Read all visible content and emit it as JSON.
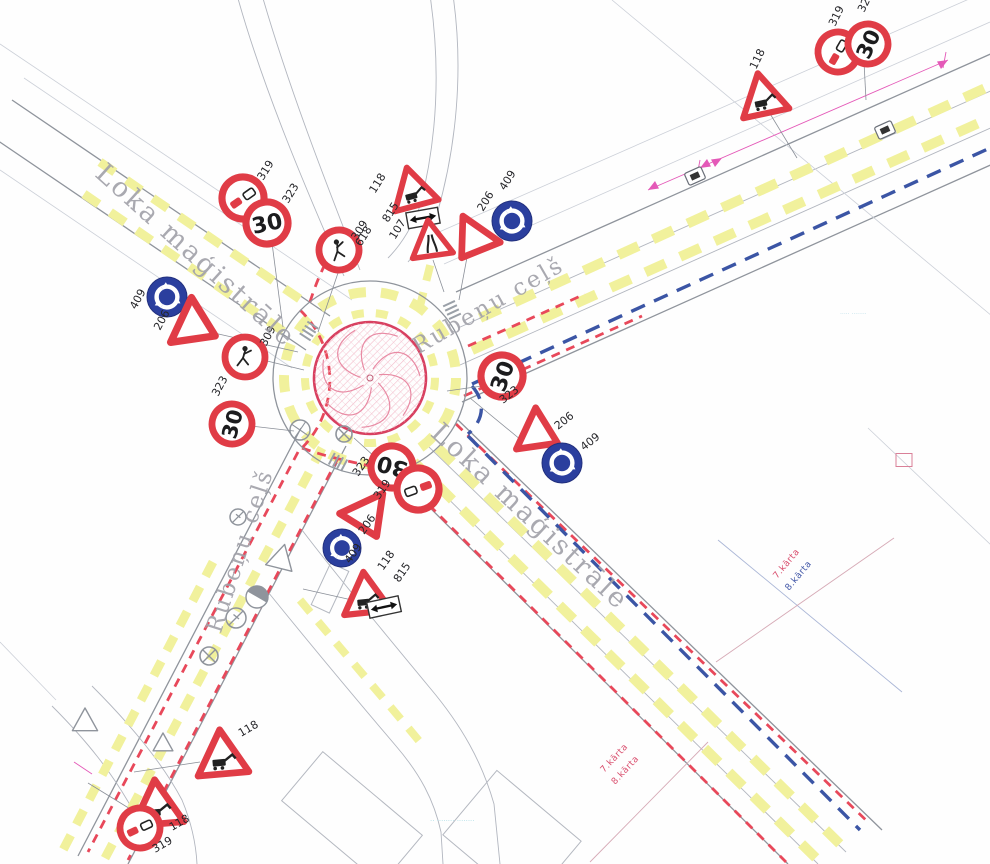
{
  "plan": {
    "type": "roundabout traffic-management scheme drawing",
    "colors": {
      "sign_red": "#e03c46",
      "sign_blue": "#2b3f9e",
      "marking_yellow": "#f1f19c",
      "temp_red": "#e8485a",
      "phase_blue": "#3b55a5",
      "magenta": "#e459b8",
      "island_pink": "#d84060",
      "road_gray": "#8f949c"
    },
    "sign_glyphs": {
      "speed_limit_text": "30"
    },
    "street_labels": [
      {
        "text": "Loka maģistrāle",
        "x": 190,
        "y": 262,
        "rot": 42,
        "size": 27
      },
      {
        "text": "Rubeņu ceļš",
        "x": 492,
        "y": 312,
        "rot": -30,
        "size": 23
      },
      {
        "text": "Rubeņu ceļš",
        "x": 247,
        "y": 553,
        "rot": -72,
        "size": 23
      },
      {
        "text": "Loka maģistrāle",
        "x": 524,
        "y": 523,
        "rot": 43,
        "size": 27
      }
    ],
    "phase_labels": [
      {
        "text": "7.kārta",
        "x": 777,
        "y": 579,
        "rot": -50,
        "color": "#d94f6e"
      },
      {
        "text": "8.kārta",
        "x": 789,
        "y": 591,
        "rot": -50,
        "color": "#4459a8"
      },
      {
        "text": "7.kārta",
        "x": 604,
        "y": 773,
        "rot": -47,
        "color": "#d94f6e"
      },
      {
        "text": "8.kārta",
        "x": 615,
        "y": 785,
        "rot": -47,
        "color": "#d94f6e"
      }
    ],
    "stray_labels": [
      {
        "text": "618",
        "x": 361,
        "y": 247,
        "rot": -58
      }
    ],
    "watermarks": [
      {
        "text": "·· ········ ········",
        "x": 430,
        "y": 823,
        "size": 7,
        "color": "#a9dce6"
      },
      {
        "text": "····· ········",
        "x": 840,
        "y": 316,
        "size": 6,
        "color": "#b9dde8"
      }
    ],
    "signs": [
      {
        "type": "no-overtake",
        "x": 243,
        "y": 198,
        "r": 21,
        "rot": -35,
        "label": "319",
        "lx": 263,
        "ly": 181,
        "lrot": -58
      },
      {
        "type": "speed30",
        "x": 267,
        "y": 223,
        "r": 21,
        "rot": -12,
        "label": "323",
        "lx": 288,
        "ly": 204,
        "lrot": -58
      },
      {
        "type": "pedestrian",
        "x": 339,
        "y": 250,
        "r": 20,
        "rot": -18,
        "label": "309",
        "lx": 357,
        "ly": 241,
        "lrot": -58
      },
      {
        "type": "roadworks",
        "x": 413,
        "y": 191,
        "s": 23,
        "rot": -15,
        "label": "118",
        "lx": 375,
        "ly": 194,
        "lrot": -58
      },
      {
        "type": "two-way-plate",
        "x": 423,
        "y": 218,
        "w": 32,
        "h": 16,
        "rot": -10,
        "label": "815",
        "lx": 388,
        "ly": 223,
        "lrot": -58
      },
      {
        "type": "road-narrows",
        "x": 431,
        "y": 242,
        "s": 21,
        "rot": -8,
        "label": "107",
        "lx": 395,
        "ly": 240,
        "lrot": -58
      },
      {
        "type": "give-way",
        "x": 474,
        "y": 240,
        "s": 24,
        "rot": 35,
        "label": "206",
        "lx": 483,
        "ly": 212,
        "lrot": -58
      },
      {
        "type": "roundabout",
        "x": 512,
        "y": 221,
        "r": 20,
        "rot": 0,
        "label": "409",
        "lx": 505,
        "ly": 191,
        "lrot": -58
      },
      {
        "type": "roundabout",
        "x": 167,
        "y": 297,
        "r": 20,
        "rot": 0,
        "label": "409",
        "lx": 136,
        "ly": 310,
        "lrot": -62
      },
      {
        "type": "give-way",
        "x": 194,
        "y": 326,
        "s": 26,
        "rot": -65,
        "label": "206",
        "lx": 160,
        "ly": 331,
        "lrot": -62
      },
      {
        "type": "pedestrian",
        "x": 245,
        "y": 357,
        "r": 20,
        "rot": 0,
        "label": "309",
        "lx": 266,
        "ly": 347,
        "lrot": -62
      },
      {
        "type": "speed30",
        "x": 232,
        "y": 424,
        "r": 20,
        "rot": -75,
        "label": "323",
        "lx": 218,
        "ly": 397,
        "lrot": -62
      },
      {
        "type": "speed30",
        "x": 502,
        "y": 376,
        "r": 21,
        "rot": -70,
        "label": "323",
        "lx": 503,
        "ly": 404,
        "lrot": -38
      },
      {
        "type": "give-way",
        "x": 538,
        "y": 434,
        "s": 24,
        "rot": -65,
        "label": "206",
        "lx": 558,
        "ly": 430,
        "lrot": -38
      },
      {
        "type": "roundabout",
        "x": 562,
        "y": 463,
        "r": 20,
        "rot": 0,
        "label": "409",
        "lx": 584,
        "ly": 451,
        "lrot": -38
      },
      {
        "type": "speed30",
        "x": 392,
        "y": 467,
        "r": 21,
        "rot": 195,
        "label": "323",
        "lx": 358,
        "ly": 477,
        "lrot": -55
      },
      {
        "type": "no-overtake",
        "x": 418,
        "y": 489,
        "r": 21,
        "rot": 160,
        "label": "319",
        "lx": 379,
        "ly": 500,
        "lrot": -55
      },
      {
        "type": "give-way",
        "x": 367,
        "y": 516,
        "s": 25,
        "rot": -25,
        "label": "206",
        "lx": 364,
        "ly": 535,
        "lrot": -55
      },
      {
        "type": "roundabout",
        "x": 342,
        "y": 548,
        "r": 19,
        "rot": 0,
        "label": "409",
        "lx": 350,
        "ly": 564,
        "lrot": -55
      },
      {
        "type": "roadworks",
        "x": 366,
        "y": 597,
        "s": 24,
        "rot": -6,
        "label": "118",
        "lx": 383,
        "ly": 571,
        "lrot": -55
      },
      {
        "type": "two-way-plate",
        "x": 384,
        "y": 607,
        "w": 32,
        "h": 16,
        "rot": -12,
        "label": "815",
        "lx": 399,
        "ly": 583,
        "lrot": -55
      },
      {
        "type": "roadworks",
        "x": 763,
        "y": 98,
        "s": 24,
        "rot": -12,
        "label": "118",
        "lx": 756,
        "ly": 70,
        "lrot": -64
      },
      {
        "type": "no-overtake",
        "x": 838,
        "y": 52,
        "r": 20,
        "rot": -60,
        "label": "319",
        "lx": 835,
        "ly": 27,
        "lrot": -64
      },
      {
        "type": "speed30",
        "x": 868,
        "y": 44,
        "r": 20,
        "rot": -65,
        "label": "323",
        "lx": 864,
        "ly": 13,
        "lrot": -64
      },
      {
        "type": "roadworks",
        "x": 222,
        "y": 757,
        "s": 26,
        "rot": -5,
        "label": "118",
        "lx": 241,
        "ly": 737,
        "lrot": -30
      },
      {
        "type": "roadworks",
        "x": 157,
        "y": 807,
        "s": 26,
        "rot": -5,
        "label": "118",
        "lx": 172,
        "ly": 831,
        "lrot": -30
      },
      {
        "type": "no-overtake",
        "x": 140,
        "y": 828,
        "r": 20,
        "rot": -25,
        "label": "319",
        "lx": 155,
        "ly": 853,
        "lrot": -30
      }
    ],
    "existing_symbols": [
      {
        "type": "wheel",
        "x": 300,
        "y": 430,
        "r": 10
      },
      {
        "type": "x-circle",
        "x": 344,
        "y": 434,
        "r": 8
      },
      {
        "type": "x-circle",
        "x": 209,
        "y": 656,
        "r": 9
      },
      {
        "type": "half-circle",
        "x": 257,
        "y": 597,
        "r": 11
      },
      {
        "type": "slash-circle",
        "x": 236,
        "y": 618,
        "r": 10
      },
      {
        "type": "slash-circle",
        "x": 238,
        "y": 517,
        "r": 8
      },
      {
        "type": "gray-triangle",
        "x": 281,
        "y": 559,
        "s": 15,
        "rot": 14
      },
      {
        "type": "gray-triangle",
        "x": 85,
        "y": 722,
        "s": 14,
        "rot": 0
      },
      {
        "type": "gray-triangle",
        "x": 163,
        "y": 744,
        "s": 11,
        "rot": 0
      },
      {
        "type": "bus-stop",
        "x": 695,
        "y": 176,
        "rot": -24
      },
      {
        "type": "bus-stop",
        "x": 885,
        "y": 130,
        "rot": -24
      }
    ],
    "leaders": [
      [
        272,
        243,
        283,
        327
      ],
      [
        339,
        270,
        318,
        332
      ],
      [
        433,
        260,
        444,
        292
      ],
      [
        468,
        252,
        459,
        300
      ],
      [
        214,
        333,
        298,
        352
      ],
      [
        263,
        360,
        304,
        370
      ],
      [
        251,
        426,
        294,
        431
      ],
      [
        489,
        385,
        447,
        391
      ],
      [
        521,
        440,
        470,
        398
      ],
      [
        398,
        478,
        354,
        438
      ],
      [
        352,
        600,
        303,
        589
      ],
      [
        769,
        112,
        797,
        158
      ],
      [
        864,
        62,
        866,
        100
      ],
      [
        200,
        762,
        134,
        772
      ],
      [
        140,
        815,
        88,
        783
      ]
    ]
  }
}
